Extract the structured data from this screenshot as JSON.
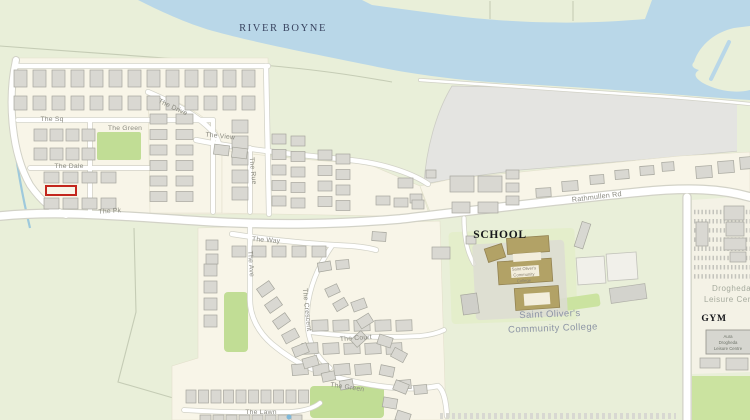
{
  "map": {
    "water_label": {
      "text": "RIVER BOYNE"
    },
    "poi_labels": {
      "school_caption": "SCHOOL",
      "gym_caption": "GYM",
      "college_name_line1": "Saint Oliver's",
      "college_name_line2": "Community College",
      "college_building_line1": "Saint Oliver's",
      "college_building_line2": "Community",
      "college_building_line3": "College",
      "leisure_line1": "Drogheda",
      "leisure_line2": "Leisure Centre",
      "aura_line1": "Aura",
      "aura_line2": "Drogheda",
      "aura_line3": "Leisure Centre"
    },
    "street_labels": [
      {
        "id": "the-sq",
        "text": "The Sq"
      },
      {
        "id": "the-green-north",
        "text": "The Green"
      },
      {
        "id": "the-dale",
        "text": "The Dale"
      },
      {
        "id": "the-drive",
        "text": "The Drive"
      },
      {
        "id": "the-view",
        "text": "The View"
      },
      {
        "id": "the-rue",
        "text": "The Rue"
      },
      {
        "id": "the-pk",
        "text": "The Pk"
      },
      {
        "id": "rathmullen-rd",
        "text": "Rathmullen Rd"
      },
      {
        "id": "the-way",
        "text": "The Way"
      },
      {
        "id": "the-ave",
        "text": "The Ave"
      },
      {
        "id": "the-crescent",
        "text": "The Crescent"
      },
      {
        "id": "the-court",
        "text": "The Court"
      },
      {
        "id": "the-green-south",
        "text": "The Green"
      },
      {
        "id": "the-lawn",
        "text": "The Lawn"
      }
    ],
    "colors": {
      "water": "#b9d7e8",
      "land": "#e9efd9",
      "residential": "#f8f5e8",
      "park": "#c1dd95",
      "industrial_area": "#e4e4e1",
      "building": "#d9d8d2",
      "road_casing": "#d2d2c7",
      "school_building": "#b2a266",
      "highlight": "#c3261d",
      "street_label": "#8b8b81",
      "stream": "#9ec9dc"
    }
  }
}
